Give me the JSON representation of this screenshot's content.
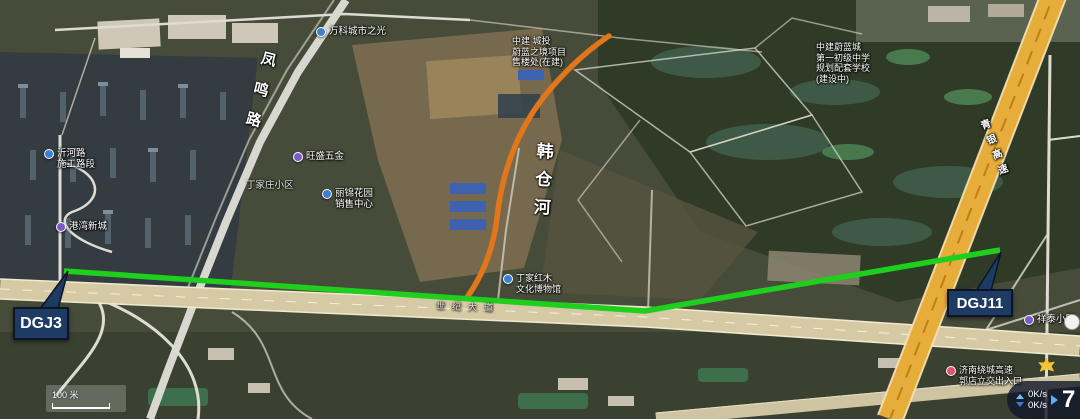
{
  "map": {
    "scale_label": "100 米",
    "road_names": {
      "fengming": "凤鸣路",
      "avenue": "世纪大道",
      "highway": "青银高速"
    },
    "river_name": "韩仓河",
    "pois": {
      "vanke": {
        "lines": [
          "万科城市之光"
        ]
      },
      "zhongjian": {
        "lines": [
          "中建 城投",
          "蔚蓝之境项目",
          "售楼处(在建)"
        ]
      },
      "school": {
        "lines": [
          "中建蔚蓝城",
          "第一初级中学",
          "规划配套学校",
          "(建设中)"
        ]
      },
      "construction": {
        "lines": [
          "沂河路",
          "施工路段"
        ]
      },
      "gangwan": {
        "lines": [
          "港湾新城"
        ]
      },
      "wangsheng": {
        "lines": [
          "旺盛五金"
        ]
      },
      "dingjia": {
        "lines": [
          "丁家庄小区"
        ]
      },
      "sales": {
        "lines": [
          "丽锦花园",
          "销售中心"
        ]
      },
      "museum": {
        "lines": [
          "丁家红木",
          "文化博物馆"
        ]
      },
      "exit": {
        "lines": [
          "济南绕城高速",
          "郭店立交出入口"
        ]
      },
      "xiaoqu": {
        "lines": [
          "祥泰小区"
        ]
      }
    }
  },
  "annotations": {
    "start_label": "DGJ3",
    "end_label": "DGJ11",
    "line_color": "#1ecf1e",
    "river_color": "#e2761b",
    "box_color": "#1d3b63"
  },
  "overlay": {
    "upload_speed": "0K/s",
    "download_speed": "0K/s",
    "corner_digit": "7"
  }
}
